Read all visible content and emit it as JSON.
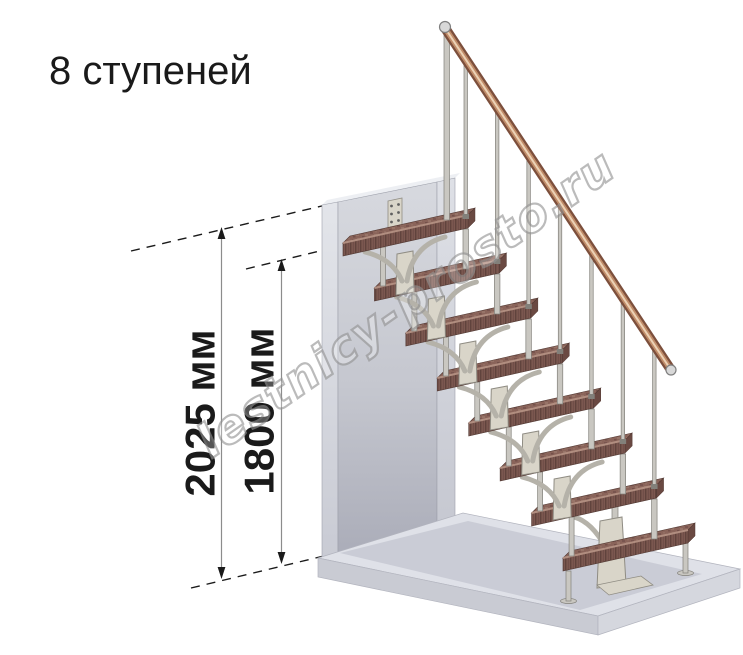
{
  "title": "8 ступеней",
  "watermark": "lestnicy-prosto.ru",
  "stairs": {
    "step_count": 8
  },
  "dimensions": [
    {
      "id": "total-height",
      "label": "2025 мм"
    },
    {
      "id": "top-step-height",
      "label": "1800 мм"
    }
  ],
  "colors": {
    "ink": "#1a1a1a",
    "dim_line": "#8c8c8c",
    "wall_edge": "#9da0ab",
    "wall_top": "#edeff3",
    "floor_top": "#dfe1e8",
    "floor_front_left": "#c9cbd3",
    "floor_front_right": "#d5d7de",
    "floor_edge": "#b2b4be",
    "shadow": "#9ea1b0",
    "tread_base": "#8a645a",
    "tread_dark": "#73504a",
    "tread_dark2": "#654440",
    "tread_light": "#9a786c",
    "tread_front": "#7c5850",
    "tread_grain": "#5c403a",
    "tread_end": "#6a4942",
    "tread_hl": "#b18e80",
    "tread_edge": "#513832",
    "metal": "#c9c7c1",
    "metal_edge": "#82807a",
    "spine": "#d9d5c9",
    "spine_edge": "#8f8c83",
    "spine_arm": "#b5b2a9",
    "rail_dark": "#7c4f3c",
    "rail_mid": "#c08c69",
    "rail_hl": "#ecd2b6",
    "cap": "#d8d8d8",
    "cap_edge": "#7f7f7f",
    "wm_stroke": "#939393"
  }
}
